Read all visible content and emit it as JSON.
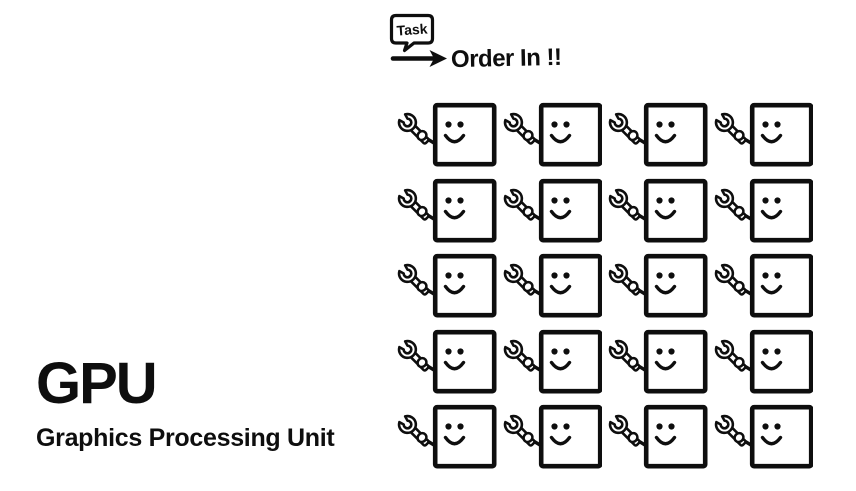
{
  "colors": {
    "ink": "#0e0e0e",
    "background": "#ffffff"
  },
  "title": {
    "heading": "GPU",
    "subheading": "Graphics Processing Unit"
  },
  "annotation": {
    "bubble_label": "Task",
    "caption": "Order In !!"
  },
  "grid": {
    "rows": 5,
    "cols": 4,
    "total_units": 20,
    "icons": {
      "wrench": "wrench-icon",
      "face": "smiley-face-icon"
    }
  }
}
